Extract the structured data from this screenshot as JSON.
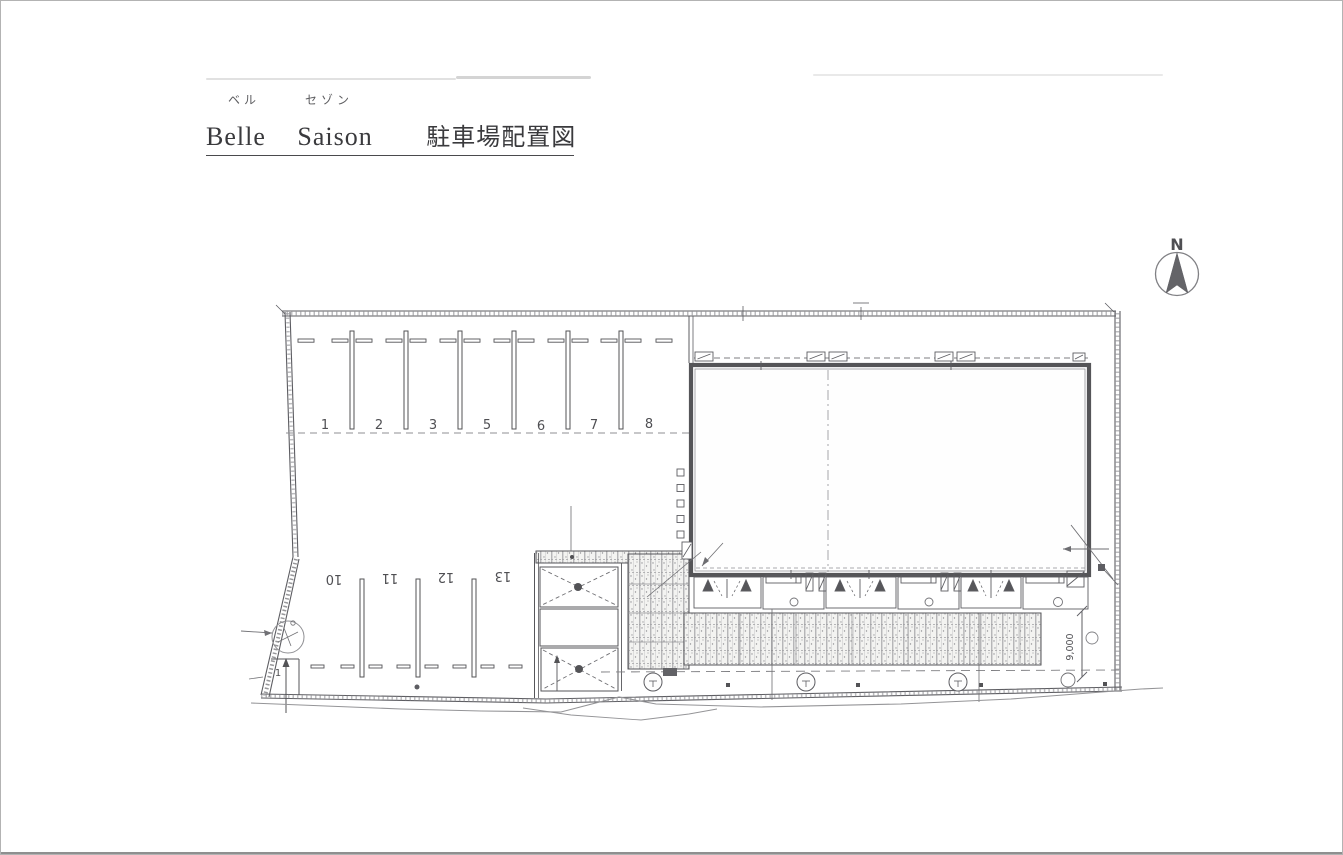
{
  "title": {
    "furigana": [
      "ベル",
      "セゾン"
    ],
    "words": [
      "Belle",
      "Saison",
      "駐車場配置図"
    ]
  },
  "compass": {
    "label": "N"
  },
  "plan": {
    "upper_spaces": [
      "1",
      "2",
      "3",
      "5",
      "6",
      "7",
      "8"
    ],
    "lower_spaces": [
      "10",
      "11",
      "12",
      "13"
    ],
    "corner_space_label": "1",
    "dimension_right": "9,000",
    "ink_color": "#4d4d52",
    "boundary_color": "#9a9a9e",
    "paper_color": "#ffffff"
  }
}
